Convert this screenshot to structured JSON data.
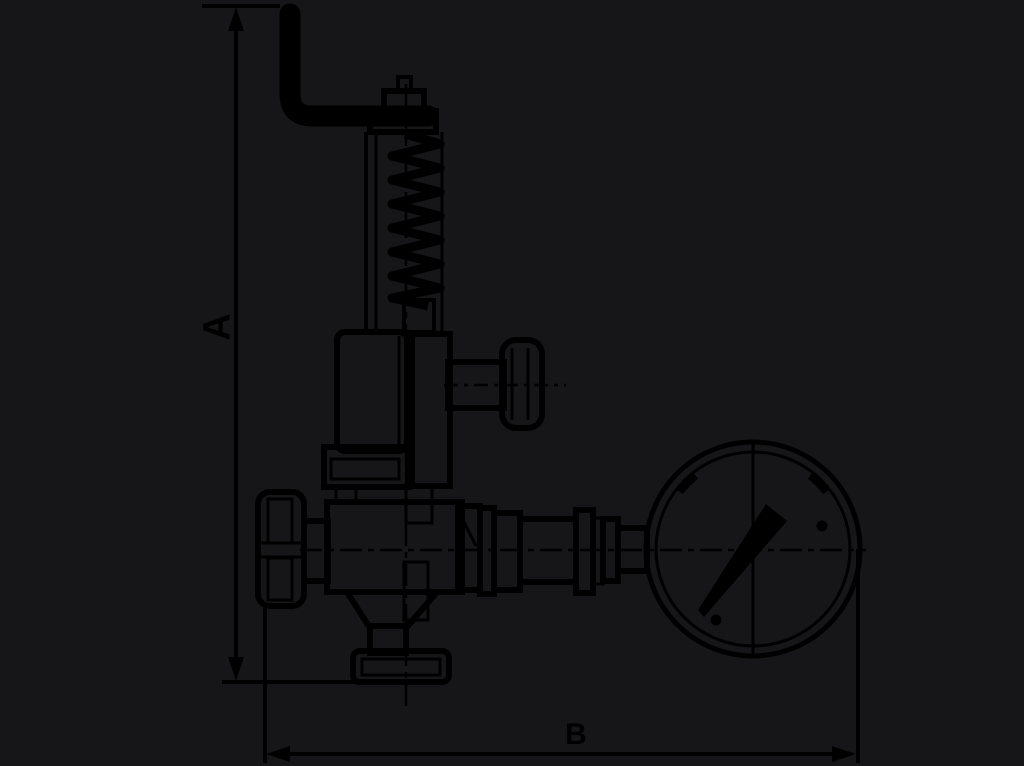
{
  "canvas": {
    "background_color": "#161618",
    "line_color": "#000000"
  },
  "dimensions": {
    "vertical_label": "A",
    "horizontal_label": "B"
  }
}
